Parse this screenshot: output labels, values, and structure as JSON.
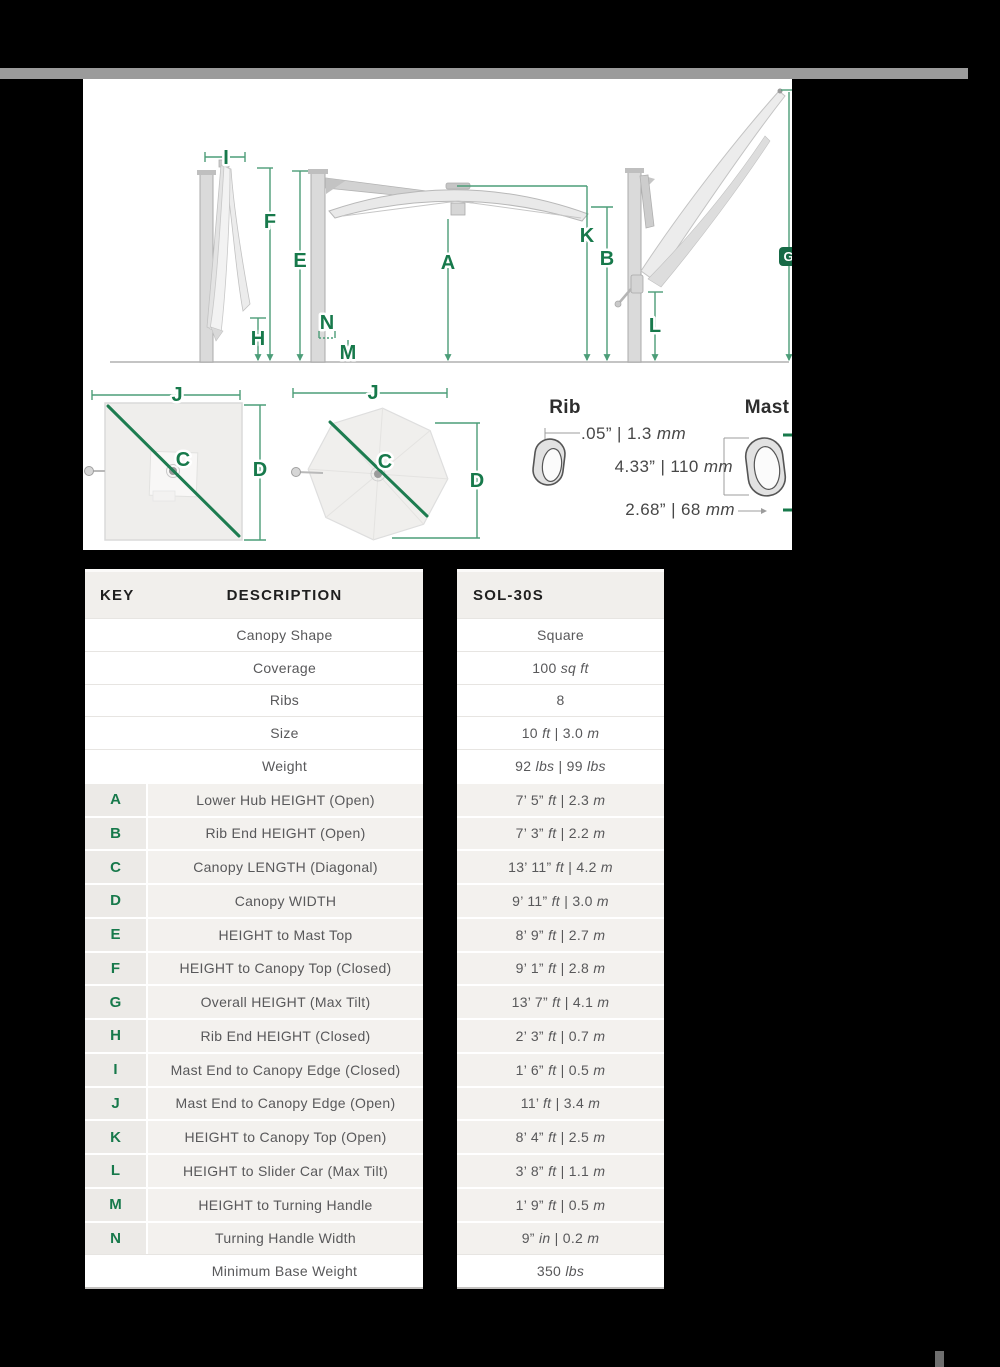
{
  "colors": {
    "accent_green": "#17794b",
    "divider_gray": "#9b9b9b",
    "key_cell_bg": "#eceae7",
    "striped_row_bg": "#f3f1ee"
  },
  "diagram": {
    "letters": {
      "a": "A",
      "b": "B",
      "c": "C",
      "d": "D",
      "e": "E",
      "f": "F",
      "g": "G",
      "h": "H",
      "i": "I",
      "j": "J",
      "k": "K",
      "l": "L",
      "m": "M",
      "n": "N"
    },
    "rib": {
      "title": "Rib",
      "wall_thickness": ".05” | 1.3 *mm*"
    },
    "mast": {
      "title": "Mast",
      "height": "4.33” | 110 *mm*",
      "width": "2.68” | 68 *mm*"
    }
  },
  "table": {
    "headers": {
      "key": "KEY",
      "description": "DESCRIPTION",
      "model": "SOL-30S"
    },
    "rows": [
      {
        "key": "",
        "desc": "Canopy Shape",
        "value": "Square"
      },
      {
        "key": "",
        "desc": "Coverage",
        "value": "100 *sq ft*"
      },
      {
        "key": "",
        "desc": "Ribs",
        "value": "8"
      },
      {
        "key": "",
        "desc": "Size",
        "value": "10 *ft* | 3.0 *m*"
      },
      {
        "key": "",
        "desc": "Weight",
        "value": "92 *lbs* | 99 *lbs*"
      },
      {
        "key": "A",
        "desc": "Lower Hub HEIGHT (Open)",
        "value": "7’ 5” *ft* | 2.3 *m*"
      },
      {
        "key": "B",
        "desc": "Rib End HEIGHT (Open)",
        "value": "7’ 3” *ft* | 2.2 *m*"
      },
      {
        "key": "C",
        "desc": "Canopy LENGTH (Diagonal)",
        "value": "13’ 11” *ft* | 4.2 *m*"
      },
      {
        "key": "D",
        "desc": "Canopy WIDTH",
        "value": "9’ 11” *ft* | 3.0 *m*"
      },
      {
        "key": "E",
        "desc": "HEIGHT to Mast Top",
        "value": "8’ 9” *ft* | 2.7 *m*"
      },
      {
        "key": "F",
        "desc": "HEIGHT to Canopy Top (Closed)",
        "value": "9’ 1” *ft* | 2.8 *m*"
      },
      {
        "key": "G",
        "desc": "Overall HEIGHT (Max Tilt)",
        "value": "13’ 7” *ft* | 4.1 *m*"
      },
      {
        "key": "H",
        "desc": "Rib End HEIGHT (Closed)",
        "value": "2’ 3” *ft* | 0.7 *m*"
      },
      {
        "key": "I",
        "desc": "Mast End to Canopy Edge (Closed)",
        "value": "1’ 6” *ft* | 0.5 *m*"
      },
      {
        "key": "J",
        "desc": "Mast End to Canopy Edge (Open)",
        "value": "11’ *ft* | 3.4 *m*"
      },
      {
        "key": "K",
        "desc": "HEIGHT to Canopy Top (Open)",
        "value": "8’ 4” *ft* | 2.5 *m*"
      },
      {
        "key": "L",
        "desc": "HEIGHT to Slider Car (Max Tilt)",
        "value": "3’ 8” *ft* | 1.1 *m*"
      },
      {
        "key": "M",
        "desc": "HEIGHT to Turning Handle",
        "value": "1’ 9” *ft* | 0.5 *m*"
      },
      {
        "key": "N",
        "desc": "Turning Handle Width",
        "value": "9” *in* | 0.2 *m*"
      },
      {
        "key": "",
        "desc": "Minimum Base Weight",
        "value": "350 *lbs*"
      }
    ]
  }
}
